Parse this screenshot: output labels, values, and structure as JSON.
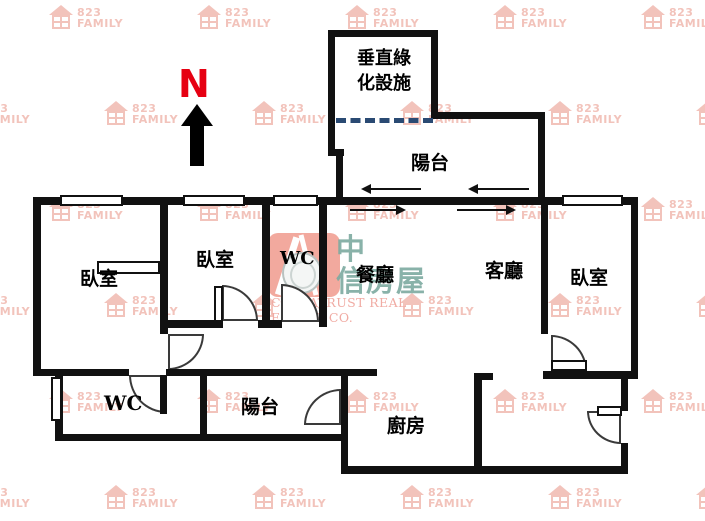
{
  "title": "apartment-floor-plan",
  "compass": {
    "label": "N"
  },
  "watermark": {
    "line1": "823",
    "line2": "FAMILY",
    "positions": [
      [
        48,
        5
      ],
      [
        196,
        5
      ],
      [
        344,
        5
      ],
      [
        492,
        5
      ],
      [
        640,
        5
      ],
      [
        -45,
        101
      ],
      [
        103,
        101
      ],
      [
        251,
        101
      ],
      [
        399,
        101
      ],
      [
        547,
        101
      ],
      [
        695,
        101
      ],
      [
        48,
        197
      ],
      [
        196,
        197
      ],
      [
        344,
        197
      ],
      [
        492,
        197
      ],
      [
        640,
        197
      ],
      [
        -45,
        293
      ],
      [
        103,
        293
      ],
      [
        251,
        293
      ],
      [
        399,
        293
      ],
      [
        547,
        293
      ],
      [
        695,
        293
      ],
      [
        48,
        389
      ],
      [
        196,
        389
      ],
      [
        344,
        389
      ],
      [
        492,
        389
      ],
      [
        640,
        389
      ],
      [
        -45,
        485
      ],
      [
        103,
        485
      ],
      [
        251,
        485
      ],
      [
        399,
        485
      ],
      [
        547,
        485
      ],
      [
        695,
        485
      ]
    ]
  },
  "facility": {
    "line1": "垂直綠",
    "line2": "化設施"
  },
  "labels": {
    "balcony_top": "陽台",
    "bed1": "臥室",
    "bed2": "臥室",
    "wc_top": "WC",
    "dining": "餐廳",
    "living": "客廳",
    "bed3": "臥室",
    "wc_bottom": "WC",
    "balcony_bottom": "陽台",
    "kitchen": "廚房"
  },
  "logo": {
    "line1": "中",
    "line2": "信房屋",
    "subtitle": "CHINATRUST REAL ESTATE CO."
  },
  "colors": {
    "wall": "#111111",
    "compass_n": "#e60012",
    "watermark": "#f0b9b0",
    "logo_mark": "#f2a99e",
    "logo_text": "#7caaa0",
    "dashed_line": "#2a4a73"
  }
}
